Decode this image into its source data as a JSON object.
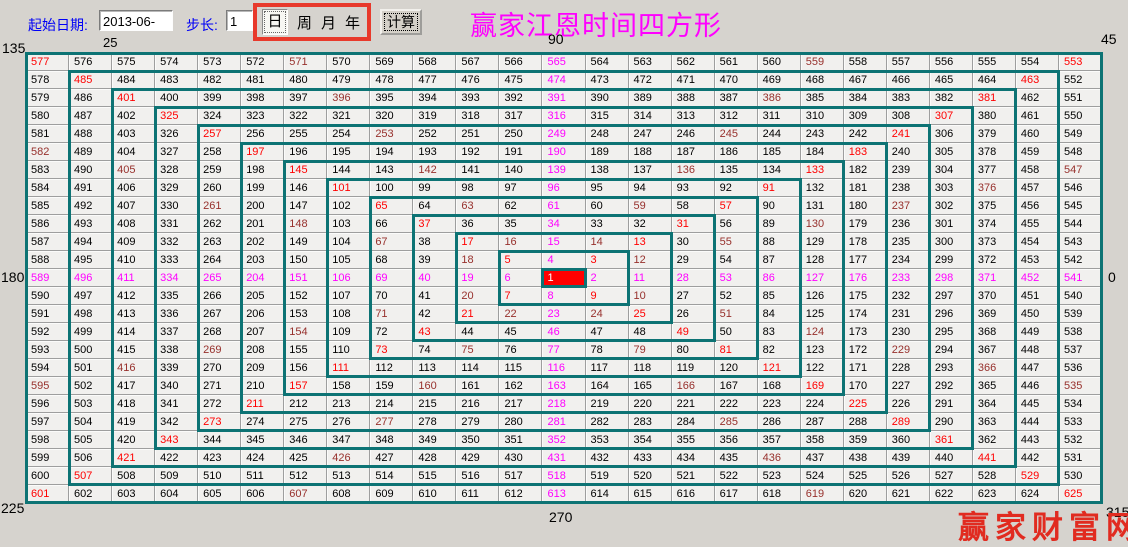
{
  "toolbar": {
    "start_date_label": "起始日期:",
    "start_date_value": "2013-06-25",
    "step_label": "步长:",
    "step_value": "1",
    "period_options": [
      "日",
      "周",
      "月",
      "年"
    ],
    "selected_period": "日",
    "calc_button": "计算"
  },
  "title": "赢家江恩时间四方形",
  "watermark": "赢家财富网",
  "angle_labels": {
    "top_left": "135",
    "top": "90",
    "top_right": "45",
    "left": "180",
    "right": "0",
    "bottom_left": "225",
    "bottom": "270",
    "bottom_right": "315"
  },
  "colors": {
    "diagonal_text": "#ff0000",
    "axis_text": "#ff00ff",
    "midpoint_text": "#97302c",
    "spiral_outline": "#0d7374",
    "highlight_bg": "#ff0000",
    "title_text": "#ff00ff",
    "toolbar_label_text": "#0000f6",
    "period_box_border": "#e8392b",
    "watermark_text": "#e12b20"
  },
  "grid": {
    "rows": [
      [
        577,
        576,
        575,
        574,
        573,
        572,
        571,
        570,
        569,
        568,
        567,
        566,
        565,
        564,
        563,
        562,
        561,
        560,
        559,
        558,
        557,
        556,
        555,
        554,
        553
      ],
      [
        578,
        485,
        484,
        483,
        482,
        481,
        480,
        479,
        478,
        477,
        476,
        475,
        474,
        473,
        472,
        471,
        470,
        469,
        468,
        467,
        466,
        465,
        464,
        463,
        552
      ],
      [
        579,
        486,
        401,
        400,
        399,
        398,
        397,
        396,
        395,
        394,
        393,
        392,
        391,
        390,
        389,
        388,
        387,
        386,
        385,
        384,
        383,
        382,
        381,
        462,
        551
      ],
      [
        580,
        487,
        402,
        325,
        324,
        323,
        322,
        321,
        320,
        319,
        318,
        317,
        316,
        315,
        314,
        313,
        312,
        311,
        310,
        309,
        308,
        307,
        380,
        461,
        550
      ],
      [
        581,
        488,
        403,
        326,
        257,
        256,
        255,
        254,
        253,
        252,
        251,
        250,
        249,
        248,
        247,
        246,
        245,
        244,
        243,
        242,
        241,
        306,
        379,
        460,
        549
      ],
      [
        582,
        489,
        404,
        327,
        258,
        197,
        196,
        195,
        194,
        193,
        192,
        191,
        190,
        189,
        188,
        187,
        186,
        185,
        184,
        183,
        240,
        305,
        378,
        459,
        548
      ],
      [
        583,
        490,
        405,
        328,
        259,
        198,
        145,
        144,
        143,
        142,
        141,
        140,
        139,
        138,
        137,
        136,
        135,
        134,
        133,
        182,
        239,
        304,
        377,
        458,
        547
      ],
      [
        584,
        491,
        406,
        329,
        260,
        199,
        146,
        101,
        100,
        99,
        98,
        97,
        96,
        95,
        94,
        93,
        92,
        91,
        132,
        181,
        238,
        303,
        376,
        457,
        546
      ],
      [
        585,
        492,
        407,
        330,
        261,
        200,
        147,
        102,
        65,
        64,
        63,
        62,
        61,
        60,
        59,
        58,
        57,
        90,
        131,
        180,
        237,
        302,
        375,
        456,
        545
      ],
      [
        586,
        493,
        408,
        331,
        262,
        201,
        148,
        103,
        66,
        37,
        36,
        35,
        34,
        33,
        32,
        31,
        56,
        89,
        130,
        179,
        236,
        301,
        374,
        455,
        544
      ],
      [
        587,
        494,
        409,
        332,
        263,
        202,
        149,
        104,
        67,
        38,
        17,
        16,
        15,
        14,
        13,
        30,
        55,
        88,
        129,
        178,
        235,
        300,
        373,
        454,
        543
      ],
      [
        588,
        495,
        410,
        333,
        264,
        203,
        150,
        105,
        68,
        39,
        18,
        5,
        4,
        3,
        12,
        29,
        54,
        87,
        128,
        177,
        234,
        299,
        372,
        453,
        542
      ],
      [
        589,
        496,
        411,
        334,
        265,
        204,
        151,
        106,
        69,
        40,
        19,
        6,
        1,
        2,
        11,
        28,
        53,
        86,
        127,
        176,
        233,
        298,
        371,
        452,
        541
      ],
      [
        590,
        497,
        412,
        335,
        266,
        205,
        152,
        107,
        70,
        41,
        20,
        7,
        8,
        9,
        10,
        27,
        52,
        85,
        126,
        175,
        232,
        297,
        370,
        451,
        540
      ],
      [
        591,
        498,
        413,
        336,
        267,
        206,
        153,
        108,
        71,
        42,
        21,
        22,
        23,
        24,
        25,
        26,
        51,
        84,
        125,
        174,
        231,
        296,
        369,
        450,
        539
      ],
      [
        592,
        499,
        414,
        337,
        268,
        207,
        154,
        109,
        72,
        43,
        44,
        45,
        46,
        47,
        48,
        49,
        50,
        83,
        124,
        173,
        230,
        295,
        368,
        449,
        538
      ],
      [
        593,
        500,
        415,
        338,
        269,
        208,
        155,
        110,
        73,
        74,
        75,
        76,
        77,
        78,
        79,
        80,
        81,
        82,
        123,
        172,
        229,
        294,
        367,
        448,
        537
      ],
      [
        594,
        501,
        416,
        339,
        270,
        209,
        156,
        111,
        112,
        113,
        114,
        115,
        116,
        117,
        118,
        119,
        120,
        121,
        122,
        171,
        228,
        293,
        366,
        447,
        536
      ],
      [
        595,
        502,
        417,
        340,
        271,
        210,
        157,
        158,
        159,
        160,
        161,
        162,
        163,
        164,
        165,
        166,
        167,
        168,
        169,
        170,
        227,
        292,
        365,
        446,
        535
      ],
      [
        596,
        503,
        418,
        341,
        272,
        211,
        212,
        213,
        214,
        215,
        216,
        217,
        218,
        219,
        220,
        221,
        222,
        223,
        224,
        225,
        226,
        291,
        364,
        445,
        534
      ],
      [
        597,
        504,
        419,
        342,
        273,
        274,
        275,
        276,
        277,
        278,
        279,
        280,
        281,
        282,
        283,
        284,
        285,
        286,
        287,
        288,
        289,
        290,
        363,
        444,
        533
      ],
      [
        598,
        505,
        420,
        343,
        344,
        345,
        346,
        347,
        348,
        349,
        350,
        351,
        352,
        353,
        354,
        355,
        356,
        357,
        358,
        359,
        360,
        361,
        362,
        443,
        532
      ],
      [
        599,
        506,
        421,
        422,
        423,
        424,
        425,
        426,
        427,
        428,
        429,
        430,
        431,
        432,
        433,
        434,
        435,
        436,
        437,
        438,
        439,
        440,
        441,
        442,
        531
      ],
      [
        600,
        507,
        508,
        509,
        510,
        511,
        512,
        513,
        514,
        515,
        516,
        517,
        518,
        519,
        520,
        521,
        522,
        523,
        524,
        525,
        526,
        527,
        528,
        529,
        530
      ],
      [
        601,
        602,
        603,
        604,
        605,
        606,
        607,
        608,
        609,
        610,
        611,
        612,
        613,
        614,
        615,
        616,
        617,
        618,
        619,
        620,
        621,
        622,
        623,
        624,
        625
      ]
    ],
    "highlight_value": 1,
    "red_values": [
      3,
      13,
      31,
      57,
      91,
      133,
      183,
      241,
      307,
      381,
      463,
      553,
      5,
      17,
      37,
      65,
      101,
      145,
      197,
      257,
      325,
      401,
      485,
      577,
      7,
      21,
      43,
      73,
      111,
      157,
      211,
      273,
      343,
      421,
      507,
      601,
      9,
      25,
      49,
      81,
      121,
      169,
      225,
      289,
      361,
      441,
      529,
      625
    ],
    "magenta_values": [
      2,
      11,
      28,
      53,
      86,
      127,
      176,
      233,
      298,
      371,
      452,
      541,
      4,
      15,
      34,
      61,
      96,
      139,
      190,
      249,
      316,
      391,
      474,
      565,
      6,
      19,
      40,
      69,
      106,
      151,
      204,
      265,
      334,
      411,
      496,
      589,
      8,
      23,
      46,
      77,
      116,
      163,
      218,
      281,
      352,
      431,
      518,
      613
    ],
    "maroon_values": [
      10,
      12,
      14,
      16,
      18,
      20,
      22,
      24,
      51,
      55,
      59,
      63,
      67,
      71,
      75,
      79,
      124,
      130,
      136,
      142,
      148,
      154,
      160,
      166,
      229,
      237,
      245,
      253,
      261,
      269,
      277,
      285,
      366,
      376,
      386,
      396,
      405,
      416,
      426,
      436,
      535,
      547,
      559,
      571,
      582,
      595,
      607,
      619
    ],
    "ring_count": 13
  }
}
